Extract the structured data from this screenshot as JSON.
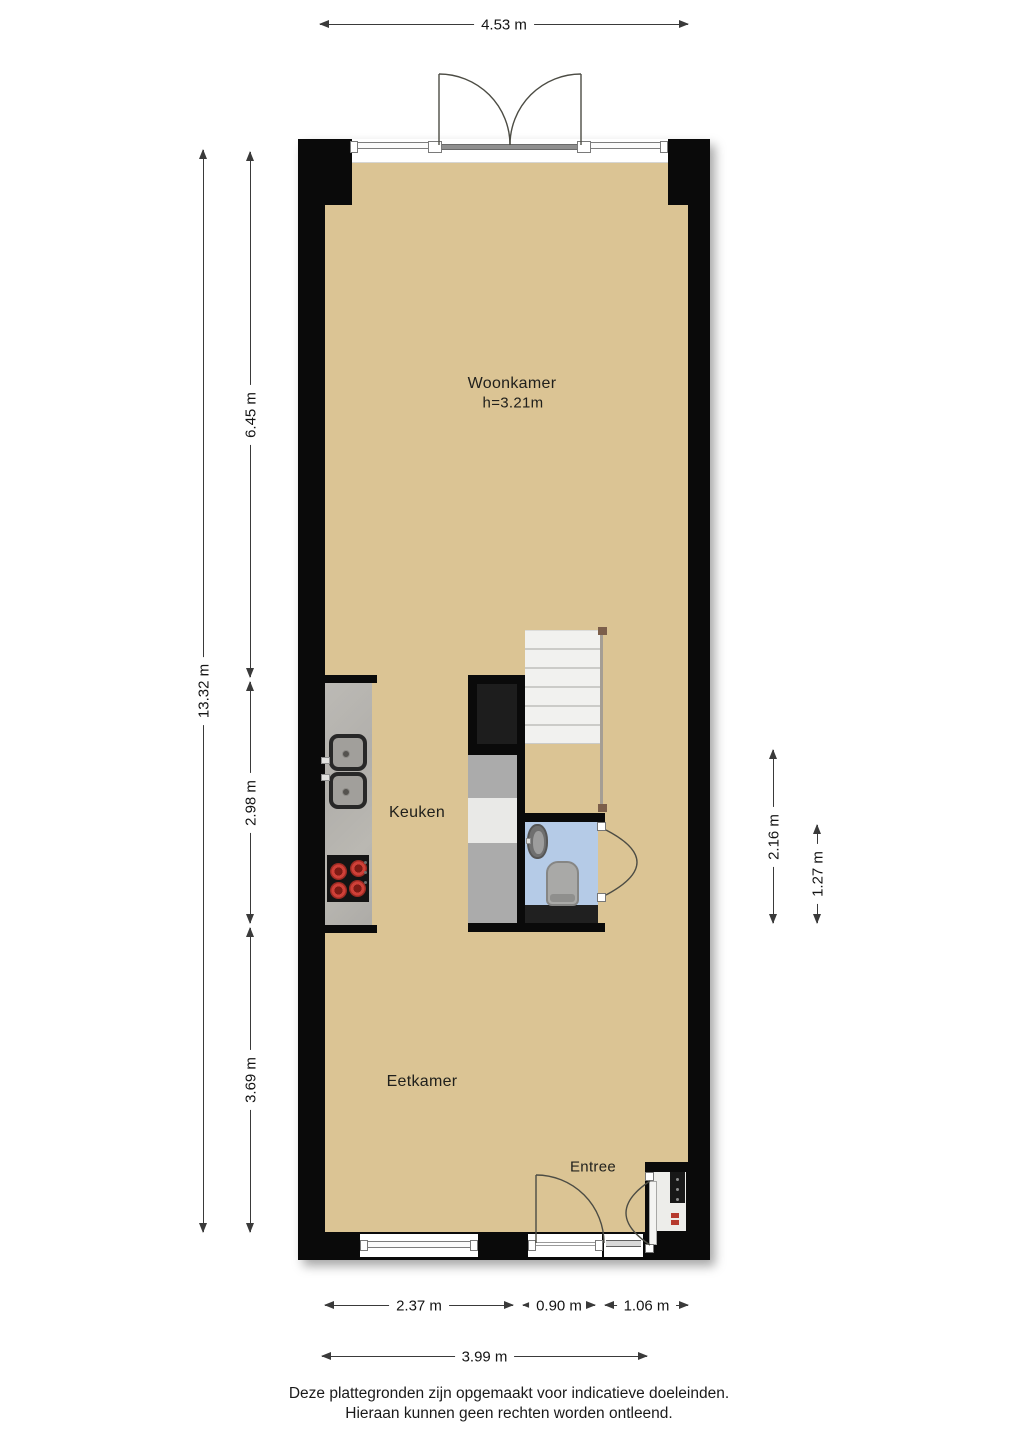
{
  "plan": {
    "rooms": {
      "woonkamer": {
        "label": "Woonkamer",
        "height_note": "h=3.21m"
      },
      "keuken": {
        "label": "Keuken"
      },
      "eetkamer": {
        "label": "Eetkamer"
      },
      "entree": {
        "label": "Entree"
      }
    },
    "dimensions": {
      "top_width": "4.53 m",
      "total_height": "13.32 m",
      "woonkamer_depth": "6.45 m",
      "keuken_depth": "2.98 m",
      "eetkamer_depth": "3.69 m",
      "stair_zone_depth": "2.16 m",
      "toilet_depth": "1.27 m",
      "bottom_left_width": "2.37 m",
      "entry_door_width": "0.90 m",
      "meter_cupboard_width": "1.06 m",
      "bottom_total_width": "3.99 m"
    }
  },
  "footer": {
    "line1": "Deze plattegronden zijn opgemaakt voor indicatieve doeleinden.",
    "line2": "Hieraan kunnen geen rechten worden ontleend."
  },
  "colors": {
    "wall": "#0a0a0a",
    "floor": "#dbc494",
    "toilet_floor": "#b5cbe7",
    "burner": "#cf4038"
  }
}
